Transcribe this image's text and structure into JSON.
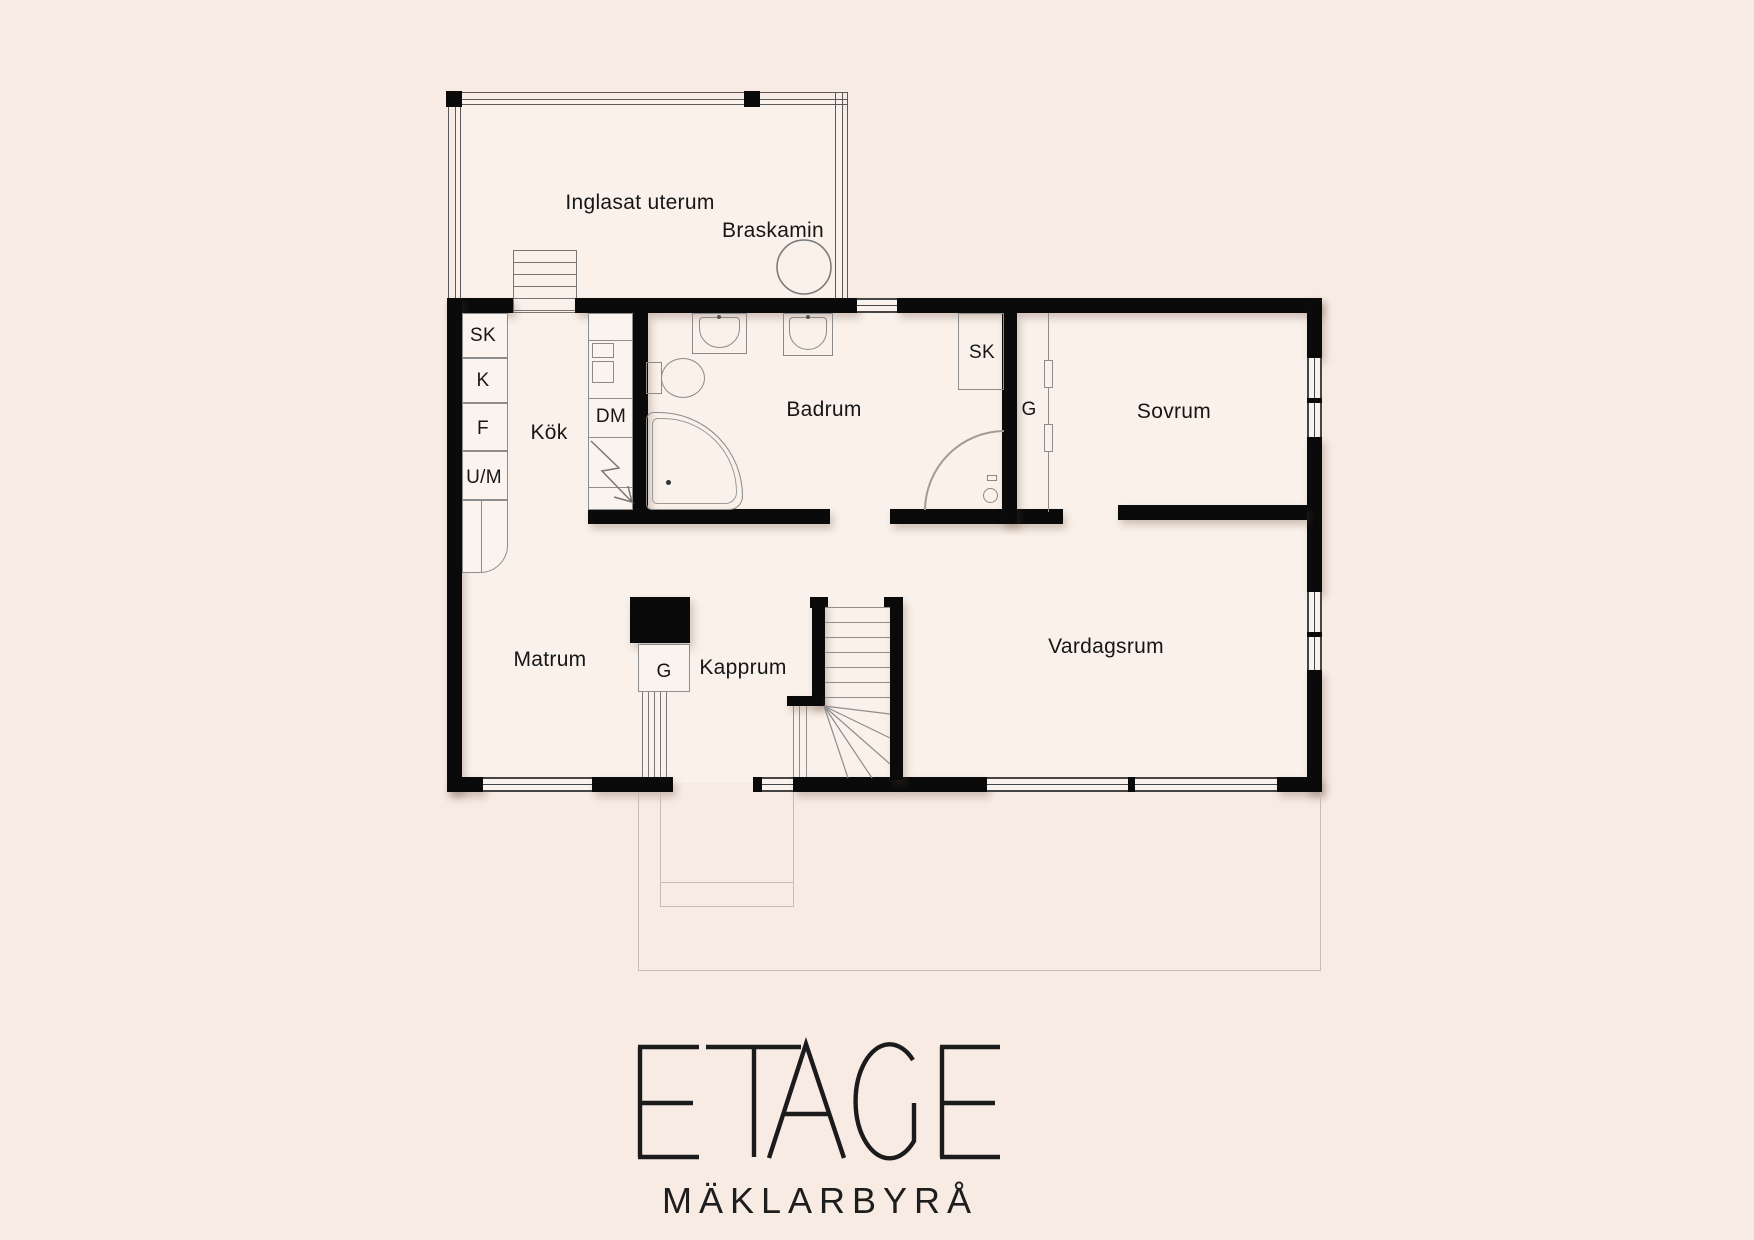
{
  "palette": {
    "background": "#f7ebe4",
    "floor": "#f9f1ea",
    "wall": "#0a0a0a",
    "thin_line": "#8d8d8d",
    "deck_line": "#c6bcb4",
    "text": "#161616"
  },
  "labels": {
    "conservatory": "Inglasat uterum",
    "fireplace": "Braskamin",
    "closet_sk_kitchen": "SK",
    "closet_k": "K",
    "closet_f": "F",
    "closet_um": "U/M",
    "kitchen": "Kök",
    "dishwasher": "DM",
    "bathroom": "Badrum",
    "closet_sk_bath": "SK",
    "closet_g_bedroom": "G",
    "bedroom": "Sovrum",
    "dining_room": "Matrum",
    "closet_g_hall": "G",
    "cloakroom": "Kapprum",
    "living_room": "Vardagsrum"
  },
  "logo": {
    "name": "ETAGE",
    "tagline": "MÄKLARBYRÅ"
  }
}
